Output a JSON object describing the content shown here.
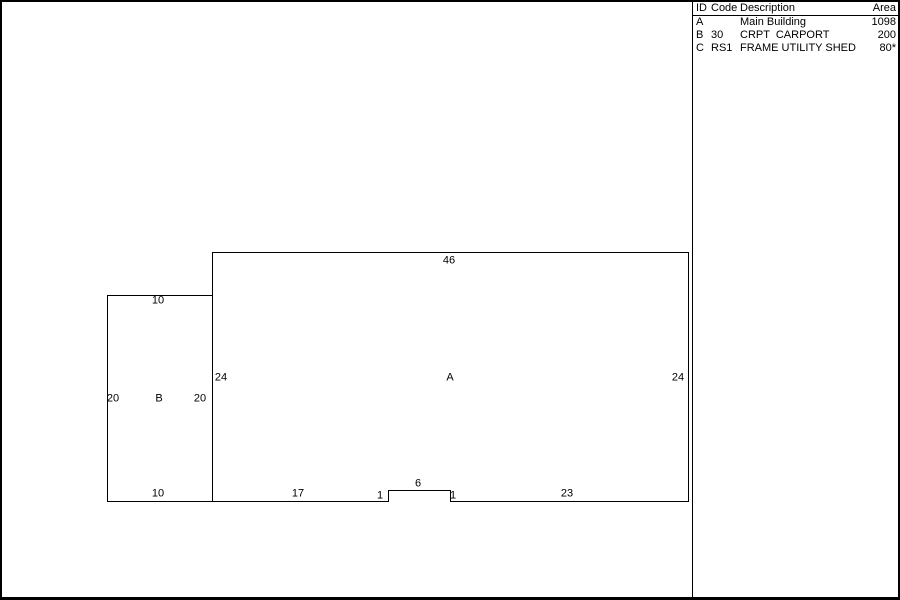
{
  "colors": {
    "line": "#000000",
    "background": "#ffffff",
    "text": "#000000"
  },
  "legend": {
    "header": {
      "id": "ID",
      "code": "Code",
      "description": "Description",
      "area": "Area"
    },
    "rows": [
      {
        "id": "A",
        "code": "",
        "description": "Main Building",
        "area": "1098"
      },
      {
        "id": "B",
        "code": "30",
        "description": "CRPT  CARPORT",
        "area": "200"
      },
      {
        "id": "C",
        "code": "RS1",
        "description": "FRAME UTILITY SHED",
        "area": "80*"
      }
    ]
  },
  "sketch": {
    "building_a": {
      "label": "A",
      "top": "46",
      "left": "24",
      "right": "24",
      "bottom_left": "17",
      "notch_left": "1",
      "notch_width": "6",
      "notch_right": "1",
      "bottom_right": "23"
    },
    "carport_b": {
      "label": "B",
      "top": "10",
      "left": "20",
      "right": "20",
      "bottom": "10"
    }
  }
}
